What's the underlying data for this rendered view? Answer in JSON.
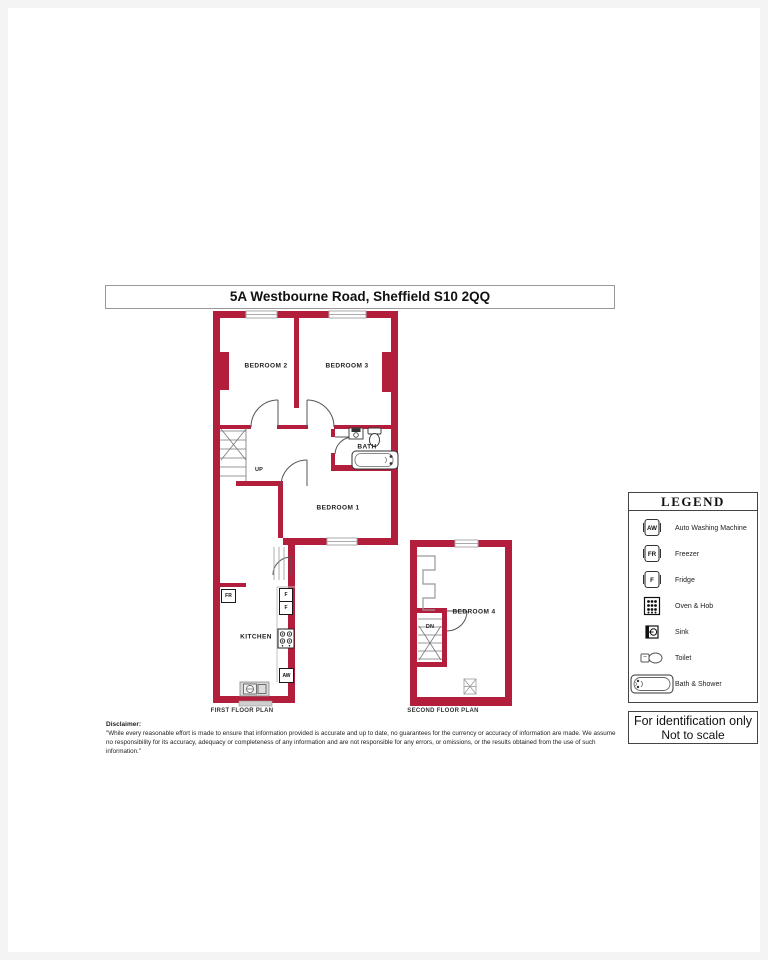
{
  "title_bar": {
    "text": "5A Westbourne Road, Sheffield S10 2QQ"
  },
  "colors": {
    "wall_red": "#b41e3d",
    "window_gray": "#b3b3b3",
    "fixture_line": "#444444"
  },
  "first_floor": {
    "caption": "FIRST FLOOR PLAN",
    "rooms": {
      "bedroom2": "BEDROOM 2",
      "bedroom3": "BEDROOM 3",
      "bath": "BATH",
      "bedroom1": "BEDROOM 1",
      "kitchen": "KITCHEN"
    },
    "stair_label": "UP",
    "appliance_tags": {
      "freezer": "FR",
      "fridge_top": "F",
      "fridge_bottom": "F",
      "washing_machine": "AW"
    }
  },
  "second_floor": {
    "caption": "SECOND FLOOR PLAN",
    "rooms": {
      "bedroom4": "BEDROOM 4"
    },
    "stair_label": "DN"
  },
  "legend": {
    "title": "LEGEND",
    "items": [
      {
        "icon": "washing-machine-icon",
        "tag": "AW",
        "label": "Auto Washing Machine"
      },
      {
        "icon": "freezer-icon",
        "tag": "FR",
        "label": "Freezer"
      },
      {
        "icon": "fridge-icon",
        "tag": "F",
        "label": "Fridge"
      },
      {
        "icon": "oven-hob-icon",
        "label": "Oven & Hob"
      },
      {
        "icon": "sink-icon",
        "label": "Sink"
      },
      {
        "icon": "toilet-icon",
        "label": "Toilet"
      },
      {
        "icon": "bath-shower-icon",
        "label": "Bath & Shower"
      }
    ],
    "footer": {
      "line1": "For identification only",
      "line2": "Not to scale"
    }
  },
  "disclaimer": {
    "heading": "Disclaimer:",
    "body": "\"While every reasonable effort is made to ensure that information provided is accurate and up to date, no guarantees for the currency or accuracy of information are made. We assume no responsibility for its accuracy, adequacy or completeness of any information and are not responsible for any errors, or omissions, or the results obtained from the use of such information.\""
  }
}
